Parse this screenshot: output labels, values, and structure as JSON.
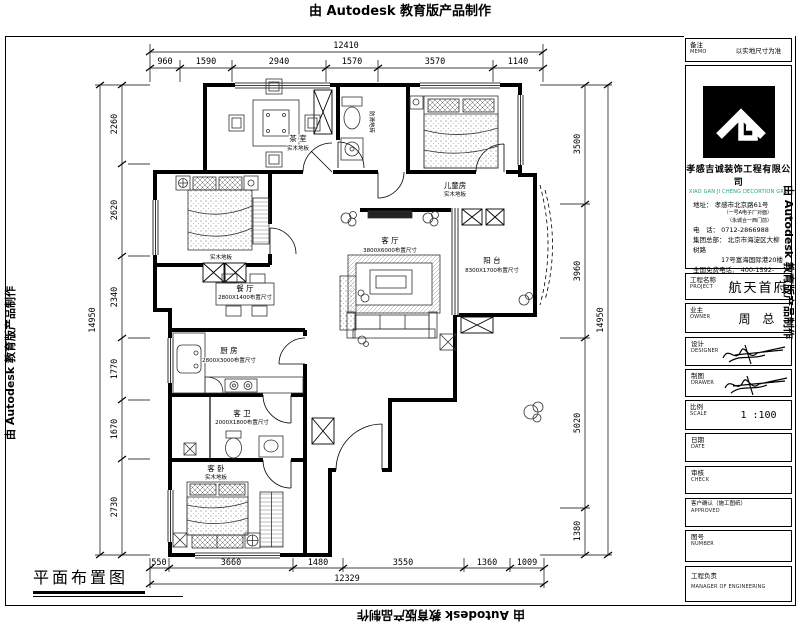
{
  "watermark": {
    "text": "由 Autodesk 教育版产品制作"
  },
  "drawing_title": "平面布置图",
  "dims": {
    "top": {
      "total": "12410",
      "segments": [
        "960",
        "1590",
        "2940",
        "1570",
        "3570",
        "1140"
      ]
    },
    "left": {
      "total": "14950",
      "segments": [
        "2260",
        "2620",
        "2340",
        "1770",
        "1670",
        "2730"
      ]
    },
    "right": {
      "total": "14950",
      "segments": [
        "3500",
        "3960",
        "5020",
        "1380"
      ]
    },
    "bottom": {
      "total": "12329",
      "segments": [
        "550",
        "3660",
        "1480",
        "3550",
        "1360",
        "1009"
      ]
    }
  },
  "rooms": {
    "tea": {
      "name": "茶 室",
      "note": "实木地板"
    },
    "child": {
      "name": "儿童房",
      "note": "实木地板"
    },
    "bath_top": {
      "note": "防滑地砖"
    },
    "bedroom_left": {
      "note": "实木地板"
    },
    "dining": {
      "name": "餐 厅",
      "note": "2800X1400布置尺寸"
    },
    "living": {
      "name": "客 厅",
      "note": "3800X6000布置尺寸"
    },
    "balcony": {
      "name": "阳 台",
      "note": "8300X1700布置尺寸"
    },
    "kitchen": {
      "name": "厨 房",
      "note": "2800X3000布置尺寸"
    },
    "bath_guest": {
      "name": "客 卫",
      "note": "2000X1800布置尺寸"
    },
    "bedroom_guest": {
      "name": "客 卧",
      "note": "实木地板"
    }
  },
  "title_block": {
    "memo": {
      "label": "备注",
      "en": "MEMO",
      "value": "以实地尺寸为准"
    },
    "company": {
      "name": "孝感吉诚装饰工程有限公司",
      "name_en": "XIAO GAN JI CHENG DECORTION GRO",
      "address": "地址： 孝感市北京路61号",
      "address_sub1": "（一号A电子厂对面）",
      "address_sub2": "（永城合一西门前）",
      "phone": "电　话： 0712-2866988",
      "hq1": "集团总部： 北京市海淀区大柳树路",
      "hq2": "17号富海国际港20楼",
      "hotline": "全国免费电话： 400-1592-9288",
      "website": "Http://www.xg.jc498.com"
    },
    "project": {
      "label": "工程名称",
      "en": "PROJECT",
      "value": "航天首府"
    },
    "owner": {
      "label": "业主",
      "en": "OWNER",
      "value": "周 总"
    },
    "designer": {
      "label": "设计",
      "en": "DESIGNER"
    },
    "drawer": {
      "label": "制图",
      "en": "DRAWER"
    },
    "scale": {
      "label": "比例",
      "en": "SCALE",
      "value": "1  :100"
    },
    "date": {
      "label": "日期",
      "en": "DATE"
    },
    "check": {
      "label": "审核",
      "en": "CHECK"
    },
    "approved": {
      "label": "客户确认（施工图纸）",
      "en": "APPROVED"
    },
    "number": {
      "label": "图号",
      "en": "NUMBER"
    },
    "manager": {
      "label": "工程负责",
      "en": "MANAGER OF ENGINEERING"
    }
  }
}
